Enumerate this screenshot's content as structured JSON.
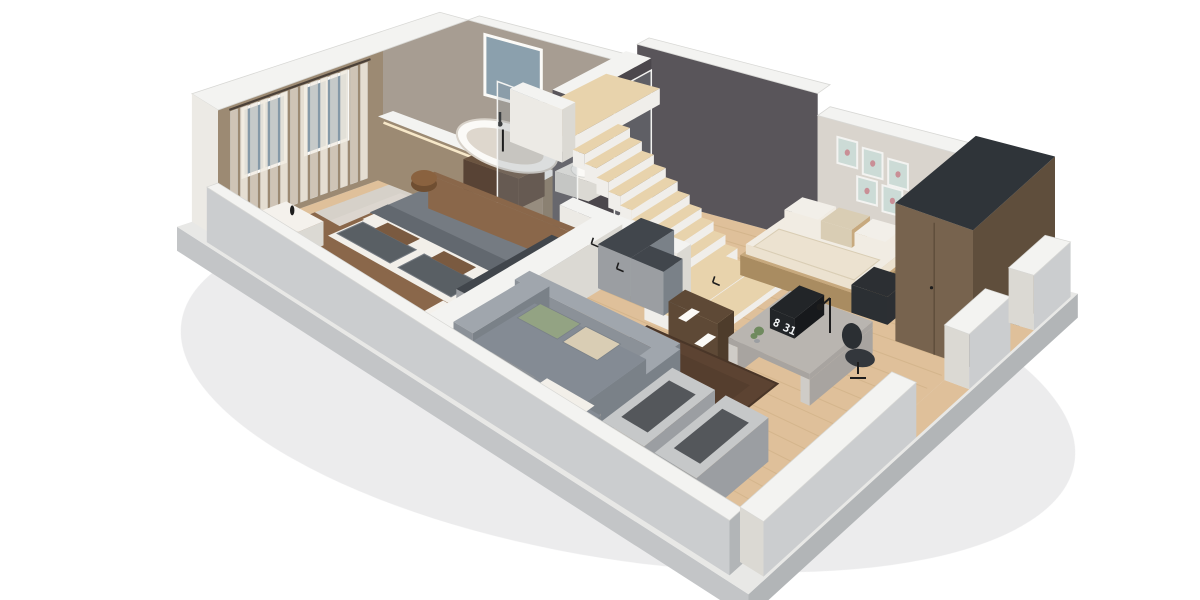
{
  "scene": {
    "type": "3d-floor-plan-cutaway-render",
    "view": "isometric-from-south",
    "background": "#ffffff",
    "rooms": [
      {
        "id": "master-bedroom"
      },
      {
        "id": "ensuite-bathroom"
      },
      {
        "id": "staircase"
      },
      {
        "id": "hallway"
      },
      {
        "id": "second-bedroom"
      },
      {
        "id": "living-area"
      }
    ],
    "objects": [
      "double-bed",
      "nightstand",
      "nightstand",
      "pouf",
      "wardrobe-cabinet-row",
      "bathtub",
      "shower-glass",
      "toilet",
      "bath-bench",
      "wood-staircase",
      "stair-landing",
      "daybed",
      "gallery-frames",
      "tall-wardrobe",
      "desk",
      "flip-clock",
      "desk-lamp",
      "desk-plant",
      "office-chair",
      "bookshelf",
      "sofa",
      "area-rug",
      "storage-units",
      "windows",
      "curtains"
    ]
  },
  "clock": {
    "hour": "8",
    "minute": "31"
  },
  "palette": {
    "bg": "#ffffff",
    "shadow": "#dcdddf",
    "slab_sw": "#c3c5c7",
    "slab_se": "#b2b5b7",
    "slab_top": "#e8e8e6",
    "wood": "#dfc09a",
    "wood_line": "#c8a87c",
    "tile": "#eae3d8",
    "carpet": "#d6d1c9",
    "carpet_light": "#ded9d1",
    "wall_top": "#f3f3f1",
    "wall_edge": "#d8d8d5",
    "wall_white": "#eceae5",
    "wall_white_dk": "#dbd9d3",
    "wall_out": "#cbcdcf",
    "taupe": "#9c8a73",
    "taupe_dk": "#8b7962",
    "bath_wall": "#a79d92",
    "dark_wall": "#59555a",
    "dark_wall2": "#4b474c",
    "light_wall": "#d9d4cd",
    "window": "#8599a7",
    "window2": "#8ba0ad",
    "curtain": "#efe9df",
    "rod": "#4a4038",
    "cove": "#f7e8c9",
    "step": "#e8d3ac",
    "step_face": "#f0eeea",
    "bed_frame": "#8a674a",
    "bed_frame_dk": "#74553a",
    "sheet": "#f2efe9",
    "duvet": "#757b82",
    "duvet_dk": "#62686f",
    "pillow": "#595f64",
    "pillow_brown": "#7a5a40",
    "pouf": "#8a623f",
    "pouf_dk": "#6f4e31",
    "ns_top": "#f4f1ec",
    "ns_face": "#e6e2da",
    "glass_top": "#41464c",
    "cab_face": "#9b9ea2",
    "sofa": "#8b9198",
    "sofa_light": "#a0a6ad",
    "sofa_dk": "#7a8188",
    "seat": "#848b94",
    "green": "#93a383",
    "beige": "#d9cdb4",
    "rug": "#5c4332",
    "rug_line": "#4a3628",
    "daybed_wood": "#c7a97e",
    "daybed_wood_dk": "#a98c61",
    "mattress": "#f1ece3",
    "blanket": "#ece2d0",
    "bag_dark": "#2c2f33",
    "wardrobe": "#77634e",
    "wardrobe_dk": "#5f4e3c",
    "wardrobe_top": "#2f3439",
    "frame_mint": "#ccdbd6",
    "frame_art": "#c98f96",
    "shelf": "#5e4936",
    "shelf_dk": "#4e3c2b",
    "desk": "#b9b5b0",
    "desk_dk": "#a8a4a0",
    "desk_leg": "#cfccc7",
    "clockbox": "#222528",
    "clockbox_dk": "#17191c",
    "chair": "#33373c",
    "chair_dk": "#2b2f33",
    "plant": "#6f8a5e",
    "unit_top": "#c6c8c9",
    "unit_in": "#54575b",
    "unit_face": "#9ea1a4",
    "glass": "#8d989e",
    "black": "#1d1d1d",
    "white": "#fbfaf7",
    "tub_in": "#ded7cd",
    "tub_rim": "#d8d2c9",
    "bench": "#6b5440",
    "bench_dk": "#584335"
  }
}
